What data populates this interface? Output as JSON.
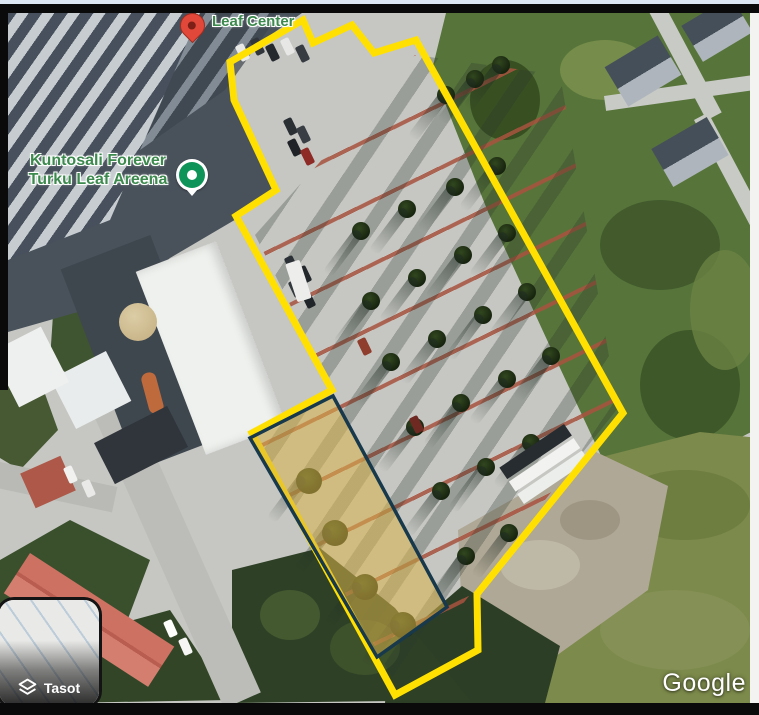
{
  "labels": {
    "leaf_center": "Leaf Center",
    "gym_line1": "Kuntosali Forever",
    "gym_line2": "Turku Leaf Areena"
  },
  "controls": {
    "layers_label": "Tasot"
  },
  "watermark": "Google",
  "colors": {
    "boundary": "#ffe000",
    "highlight_fill": "#d8b34a",
    "highlight_stroke": "#17394b",
    "label_green": "#3c8a4e",
    "pin_red": "#e2483a",
    "pin_green": "#0e9458"
  },
  "icons": {
    "red_map_pin": "red-map-pin-icon",
    "green_poi_pin": "green-poi-pin-icon",
    "layers": "layers-icon"
  }
}
